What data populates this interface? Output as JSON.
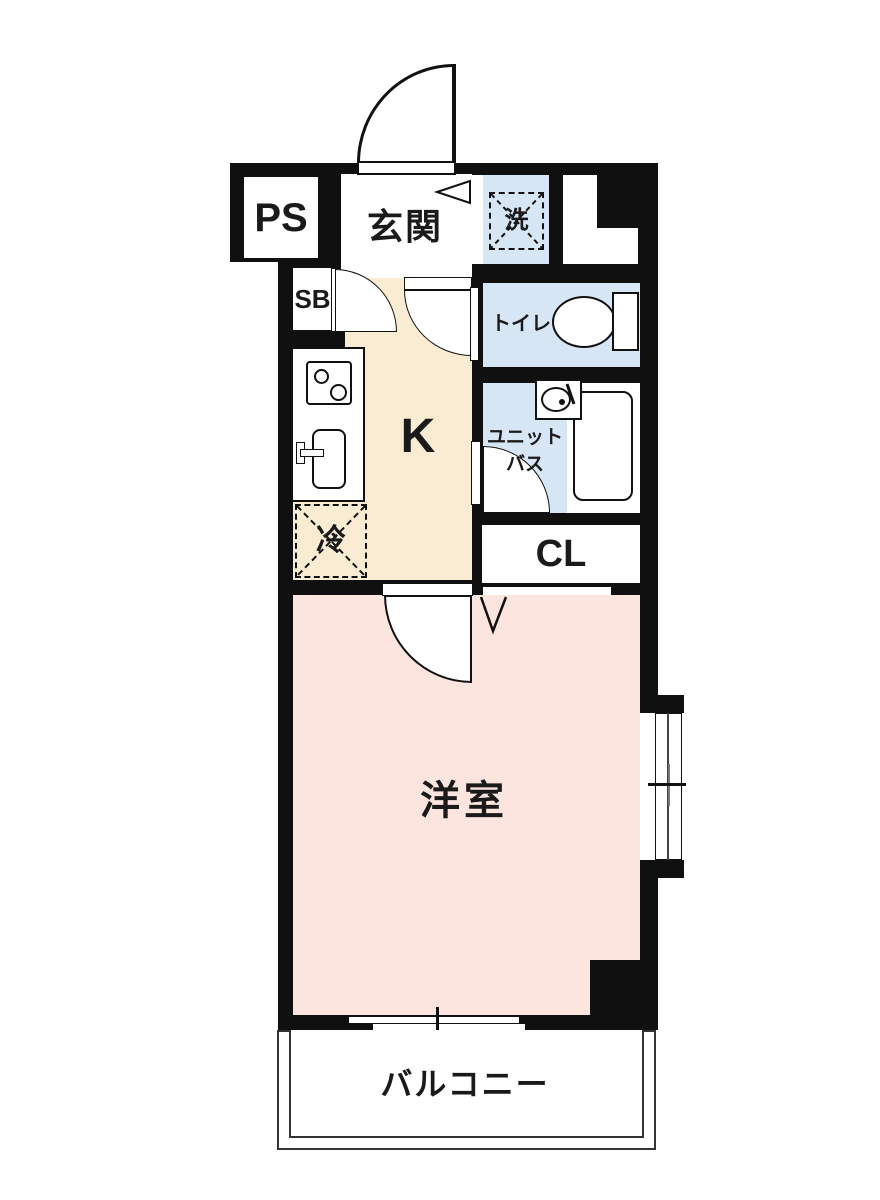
{
  "plan_type": "apartment-floorplan-1K",
  "colors": {
    "wall": "#101010",
    "kitchen_floor": "#faecd2",
    "room_floor": "#fbe5de",
    "wet_floor": "#d6e6f5",
    "line": "#1a1a1a"
  },
  "rooms": {
    "ps": {
      "label": "PS"
    },
    "entrance": {
      "label": "玄関"
    },
    "washer": {
      "label": "洗"
    },
    "shoe_box": {
      "label": "SB"
    },
    "toilet": {
      "label": "トイレ"
    },
    "kitchen": {
      "label": "K"
    },
    "unit_bath": {
      "line1": "ユニット",
      "line2": "バス"
    },
    "refrigerator": {
      "label": "冷"
    },
    "closet": {
      "label": "CL"
    },
    "western_room": {
      "label": "洋室"
    },
    "balcony": {
      "label": "バルコニー"
    }
  },
  "fixtures": {
    "stove_icon": "two-burner-stove",
    "sink_icon": "kitchen-sink",
    "toilet_icon": "toilet",
    "bathtub_icon": "bathtub",
    "washbasin_icon": "washbasin",
    "entrance_arrow_icon": "entrance-arrow",
    "door_arc_icon": "door-swing-arc",
    "window_icon": "sliding-window"
  }
}
